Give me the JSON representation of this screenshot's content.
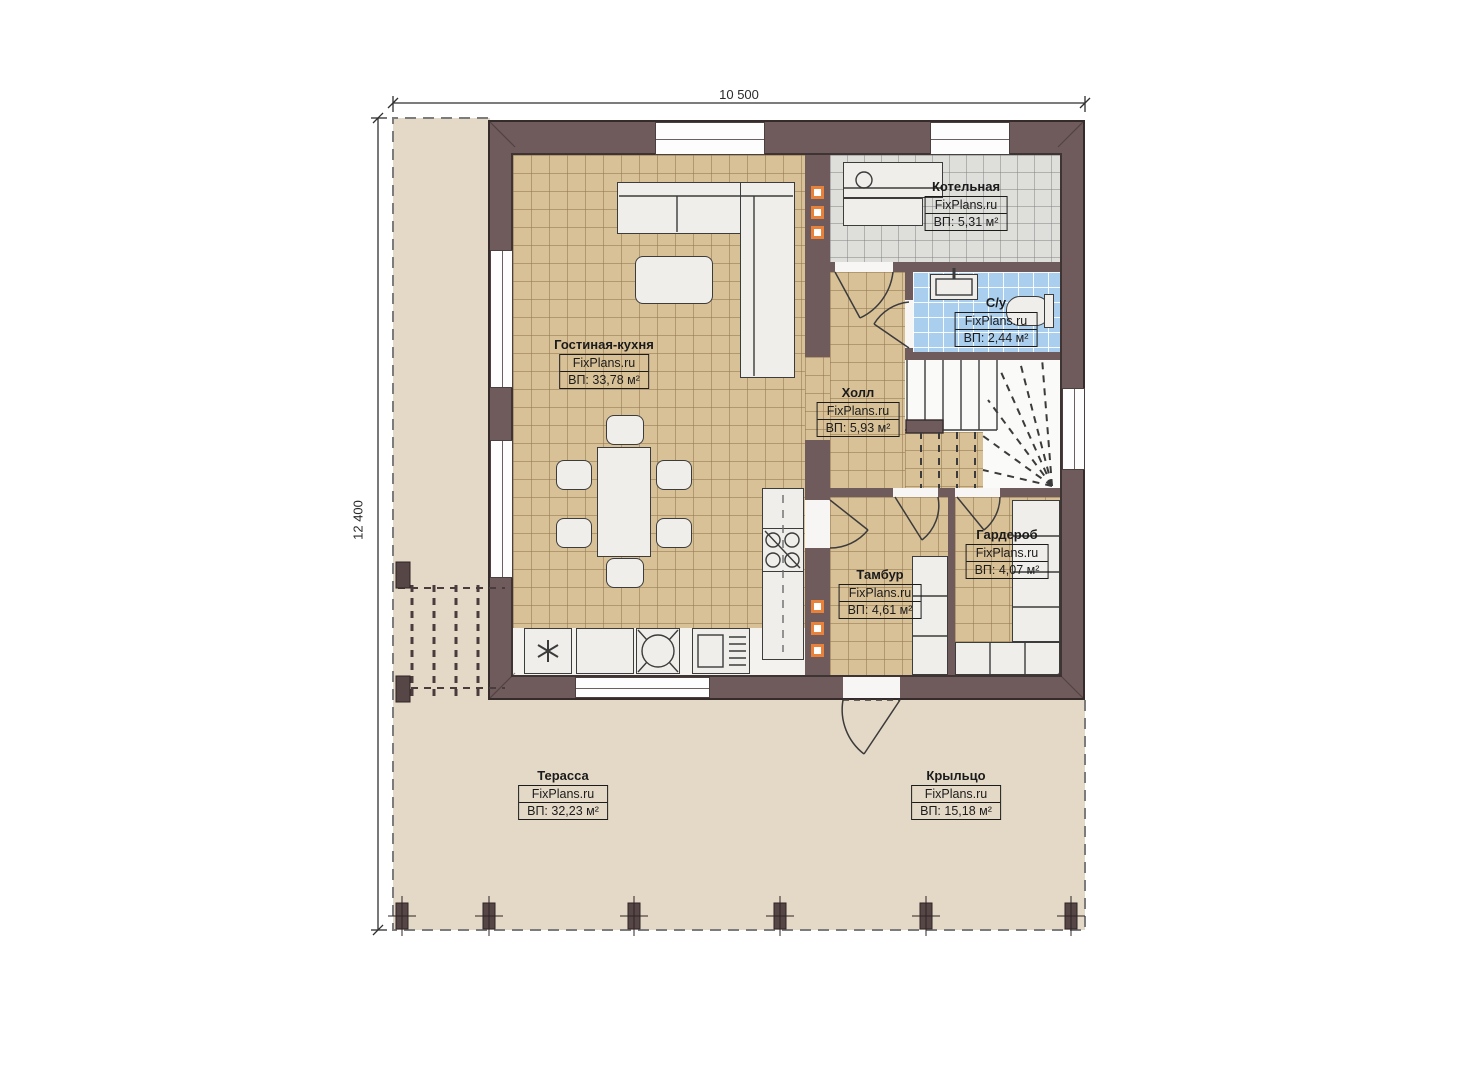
{
  "plan": {
    "dimensions": {
      "width": "10 500",
      "height": "12 400"
    },
    "rooms": [
      {
        "id": "living",
        "name": "Гостиная-кухня",
        "brand": "FixPlans.ru",
        "area": "ВП: 33,78 м²"
      },
      {
        "id": "boiler",
        "name": "Котельная",
        "brand": "FixPlans.ru",
        "area": "ВП: 5,31 м²"
      },
      {
        "id": "bath",
        "name": "С/у",
        "brand": "FixPlans.ru",
        "area": "ВП: 2,44 м²"
      },
      {
        "id": "hall",
        "name": "Холл",
        "brand": "FixPlans.ru",
        "area": "ВП: 5,93 м²"
      },
      {
        "id": "vestibule",
        "name": "Тамбур",
        "brand": "FixPlans.ru",
        "area": "ВП: 4,61 м²"
      },
      {
        "id": "wardrobe",
        "name": "Гардероб",
        "brand": "FixPlans.ru",
        "area": "ВП: 4,07 м²"
      },
      {
        "id": "terrace",
        "name": "Терасса",
        "brand": "FixPlans.ru",
        "area": "ВП: 32,23 м²"
      },
      {
        "id": "porch",
        "name": "Крыльцо",
        "brand": "FixPlans.ru",
        "area": "ВП: 15,18 м²"
      }
    ],
    "colors": {
      "wall": "#6f5b5b",
      "floor_tile_tan": "#d8c097",
      "terrace_beige": "#e4d9c7",
      "boiler_tile_gray": "#dededb",
      "bath_tile_blue": "#a9ceee",
      "accent_orange": "#e8823b"
    }
  }
}
